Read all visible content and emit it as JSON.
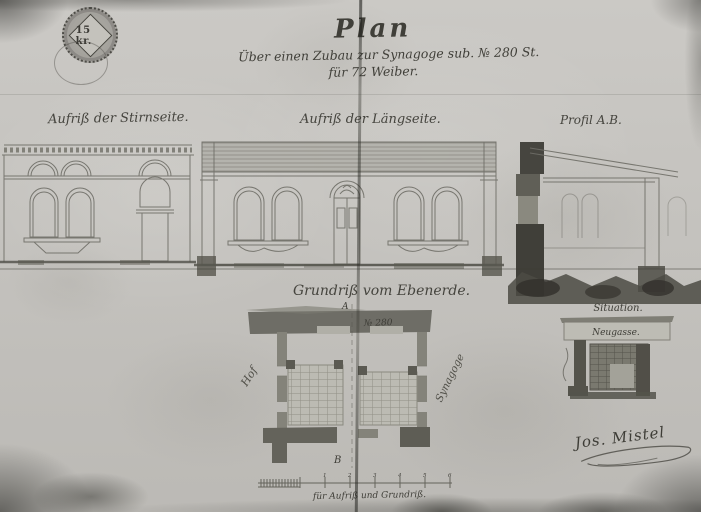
{
  "document": {
    "stamp": {
      "value": "15 kr."
    },
    "title": {
      "main": "Plan",
      "line2": "Über einen Zubau zur Synagoge sub. № 280 St.",
      "line3": "für 72 Weiber."
    },
    "labels": {
      "front_elevation": "Aufriß der Stirnseite.",
      "long_elevation": "Aufriß der Längseite.",
      "section": "Profil A.B.",
      "ground_plan": "Grundriß vom Ebenerde.",
      "site_plan": "Situation.",
      "street": "Neugasse.",
      "house_number": "№ 280",
      "courtyard": "Hof",
      "synagogue": "Synagoge",
      "mark_a": "A",
      "mark_b": "B"
    },
    "scale": {
      "caption": "für Aufriß und Grundriß.",
      "ticks": [
        "1",
        "2",
        "3",
        "4",
        "5",
        "6"
      ]
    },
    "signature": {
      "name": "Jos. Mistel"
    },
    "colors": {
      "paper": "#c7c5c1",
      "ink": "#45443e",
      "wall_dark": "#6e6d66"
    }
  }
}
